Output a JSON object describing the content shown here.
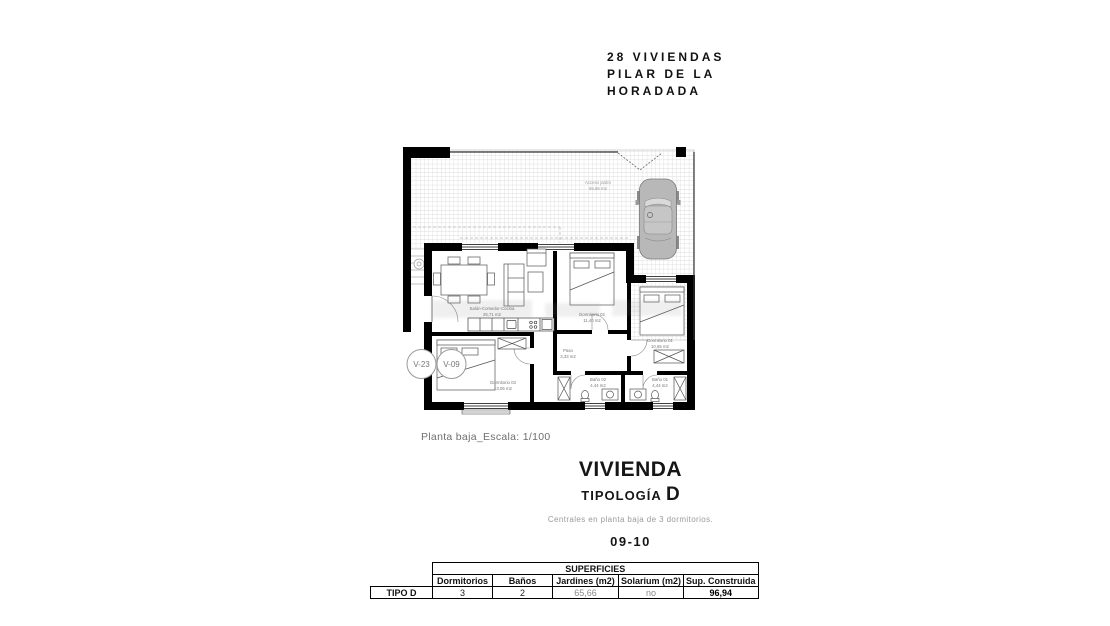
{
  "colors": {
    "wall": "#000000",
    "hatch_line": "#d0d0d0",
    "car_body": "#b8b8b8",
    "label_gray": "#8a8a8a"
  },
  "header": {
    "title_lines": [
      "28 VIVIENDAS",
      "PILAR DE LA",
      "HORADADA"
    ]
  },
  "plan": {
    "caption": "Planta baja_Escala: 1/100",
    "garden": {
      "name": "Acceso jardín",
      "area": "65,66 m2"
    },
    "unit_circles": [
      {
        "label": "V-23"
      },
      {
        "label": "V-09"
      }
    ],
    "rooms": [
      {
        "name": "Salón-Comedor-Cocina",
        "area": "25,71 m2"
      },
      {
        "name": "Dormitorio 02",
        "area": "11,40 m2"
      },
      {
        "name": "Dormitorio 01",
        "area": "10,65 m2"
      },
      {
        "name": "Paso",
        "area": "3,33 m2"
      },
      {
        "name": "Dormitorio 03",
        "area": "13,05 m2"
      },
      {
        "name": "Baño 02",
        "area": "4,44 m2"
      },
      {
        "name": "Baño 01",
        "area": "4,44 m2"
      }
    ]
  },
  "typology": {
    "title": "VIVIENDA",
    "subtitle_prefix": "TIPOLOGÍA",
    "subtitle_letter": "D",
    "description": "Centrales en planta baja de 3 dormitorios.",
    "units_range": "09-10"
  },
  "table": {
    "title": "SUPERFICIES",
    "row_header": "TIPO D",
    "columns": [
      "Dormitorios",
      "Baños",
      "Jardines (m2)",
      "Solarium (m2)",
      "Sup. Construida"
    ],
    "values": [
      "3",
      "2",
      "65,66",
      "no",
      "96,94"
    ]
  }
}
